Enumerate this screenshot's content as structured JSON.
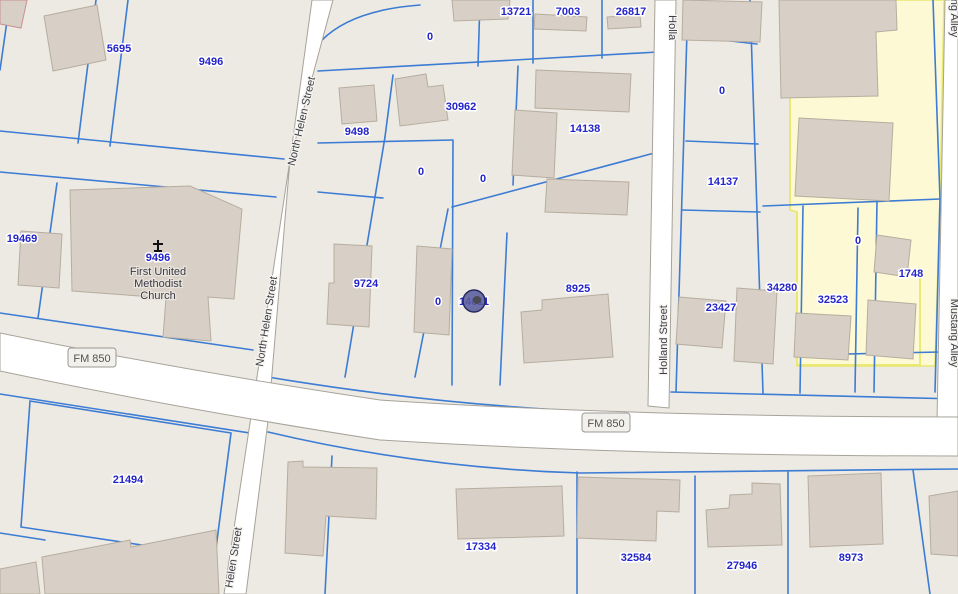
{
  "map": {
    "colors": {
      "background": "#edeae3",
      "road_fill": "#ffffff",
      "road_edge": "#a7a39a",
      "parcel_line": "#3c7cd4",
      "parcel_label": "#2424cb",
      "building_fill": "#d8d0c6",
      "building_edge": "#b6ad9f",
      "highlight_fill": "#fcf9d4",
      "highlight_edge": "#e8e86e",
      "marker_fill": "#5a5c9d",
      "marker_edge": "#272a5e"
    },
    "parcel_labels": [
      {
        "text": "5695",
        "x": 119,
        "y": 52
      },
      {
        "text": "9496",
        "x": 211,
        "y": 65
      },
      {
        "text": "0",
        "x": 430,
        "y": 40
      },
      {
        "text": "13721",
        "x": 516,
        "y": 15
      },
      {
        "text": "7003",
        "x": 568,
        "y": 15
      },
      {
        "text": "26817",
        "x": 631,
        "y": 15
      },
      {
        "text": "9498",
        "x": 357,
        "y": 135
      },
      {
        "text": "30962",
        "x": 461,
        "y": 110
      },
      {
        "text": "14138",
        "x": 585,
        "y": 132
      },
      {
        "text": "0",
        "x": 421,
        "y": 175
      },
      {
        "text": "0",
        "x": 483,
        "y": 182
      },
      {
        "text": "0",
        "x": 722,
        "y": 94
      },
      {
        "text": "14137",
        "x": 723,
        "y": 185
      },
      {
        "text": "19469",
        "x": 22,
        "y": 242
      },
      {
        "text": "9724",
        "x": 366,
        "y": 287
      },
      {
        "text": "0",
        "x": 438,
        "y": 305
      },
      {
        "text": "8925",
        "x": 578,
        "y": 292
      },
      {
        "text": "23427",
        "x": 721,
        "y": 311
      },
      {
        "text": "34280",
        "x": 782,
        "y": 291
      },
      {
        "text": "0",
        "x": 858,
        "y": 244
      },
      {
        "text": "32523",
        "x": 833,
        "y": 303
      },
      {
        "text": "1748",
        "x": 911,
        "y": 277
      },
      {
        "text": "21494",
        "x": 128,
        "y": 483
      },
      {
        "text": "17334",
        "x": 481,
        "y": 550
      },
      {
        "text": "32584",
        "x": 636,
        "y": 561
      },
      {
        "text": "27946",
        "x": 742,
        "y": 569
      },
      {
        "text": "8973",
        "x": 851,
        "y": 561
      }
    ],
    "street_labels": [
      {
        "text": "North Helen Street",
        "x": 305,
        "y": 122,
        "angle": -77
      },
      {
        "text": "North Helen Street",
        "x": 270,
        "y": 322,
        "angle": -81
      },
      {
        "text": "Helen Street",
        "x": 237,
        "y": 558,
        "angle": -81
      },
      {
        "text": "Holland Street",
        "x": 667,
        "y": 340,
        "angle": -90
      },
      {
        "text": "Holland Street",
        "x": 669,
        "y": 50,
        "angle": 90,
        "clip": [
          650,
          0,
          36,
          40
        ]
      },
      {
        "text": "Mustang Alley",
        "x": 951,
        "y": 333,
        "angle": 90
      },
      {
        "text": "Mustang Alley",
        "x": 951,
        "y": 3,
        "angle": 90
      }
    ],
    "road_badges": [
      {
        "text": "FM 850"
      },
      {
        "text": "FM 850"
      }
    ],
    "church": {
      "parcel_id": "9496",
      "line1": "First United",
      "line2": "Methodist",
      "line3": "Church"
    },
    "marker": {
      "label": "14611",
      "x": 474,
      "y": 301
    }
  }
}
